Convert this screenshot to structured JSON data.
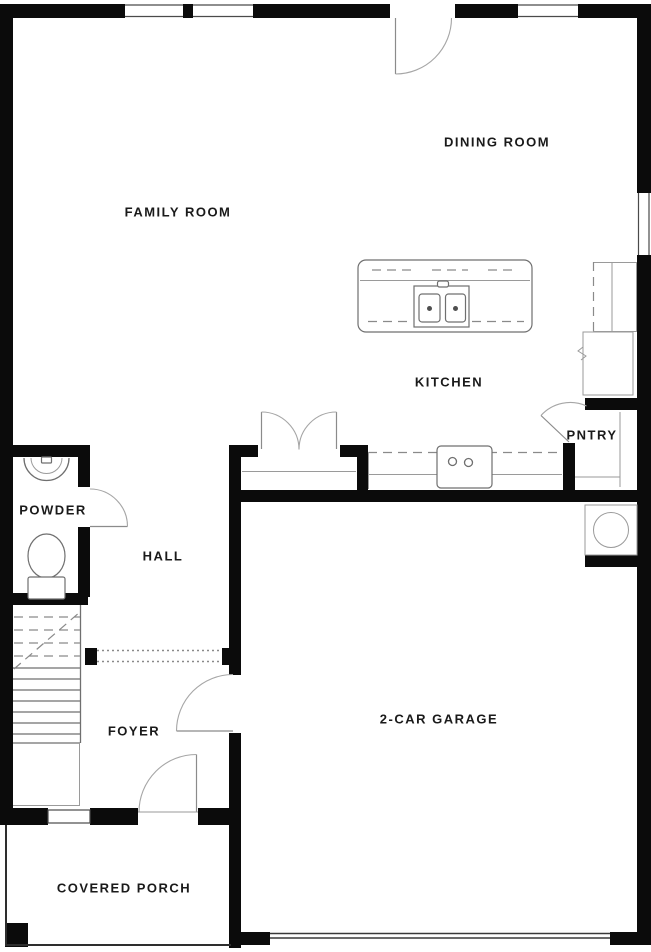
{
  "rooms": {
    "family_room": "FAMILY ROOM",
    "dining_room": "DINING ROOM",
    "kitchen": "KITCHEN",
    "pantry": "PNTRY",
    "powder": "POWDER",
    "hall": "HALL",
    "foyer": "FOYER",
    "garage": "2-CAR GARAGE",
    "porch": "COVERED PORCH"
  },
  "fixtures": [
    "kitchen-island-with-double-sink",
    "range-cooktop",
    "refrigerator",
    "upper-cabinets",
    "pantry-shelves",
    "water-heater",
    "toilet",
    "vanity-sink",
    "staircase",
    "under-stair-closet",
    "entry-closet-double-doors",
    "pantry-door",
    "powder-door",
    "garage-entry-door",
    "front-door",
    "patio-door",
    "garage-overhead-door",
    "windows"
  ],
  "colors": {
    "wall": "#0b0b0b",
    "thin_line": "#6f6f6f",
    "door_arc": "#a6a6a6",
    "dashed_line": "#8a8a8a",
    "label_text": "#1a1a1a",
    "background": "#ffffff"
  }
}
